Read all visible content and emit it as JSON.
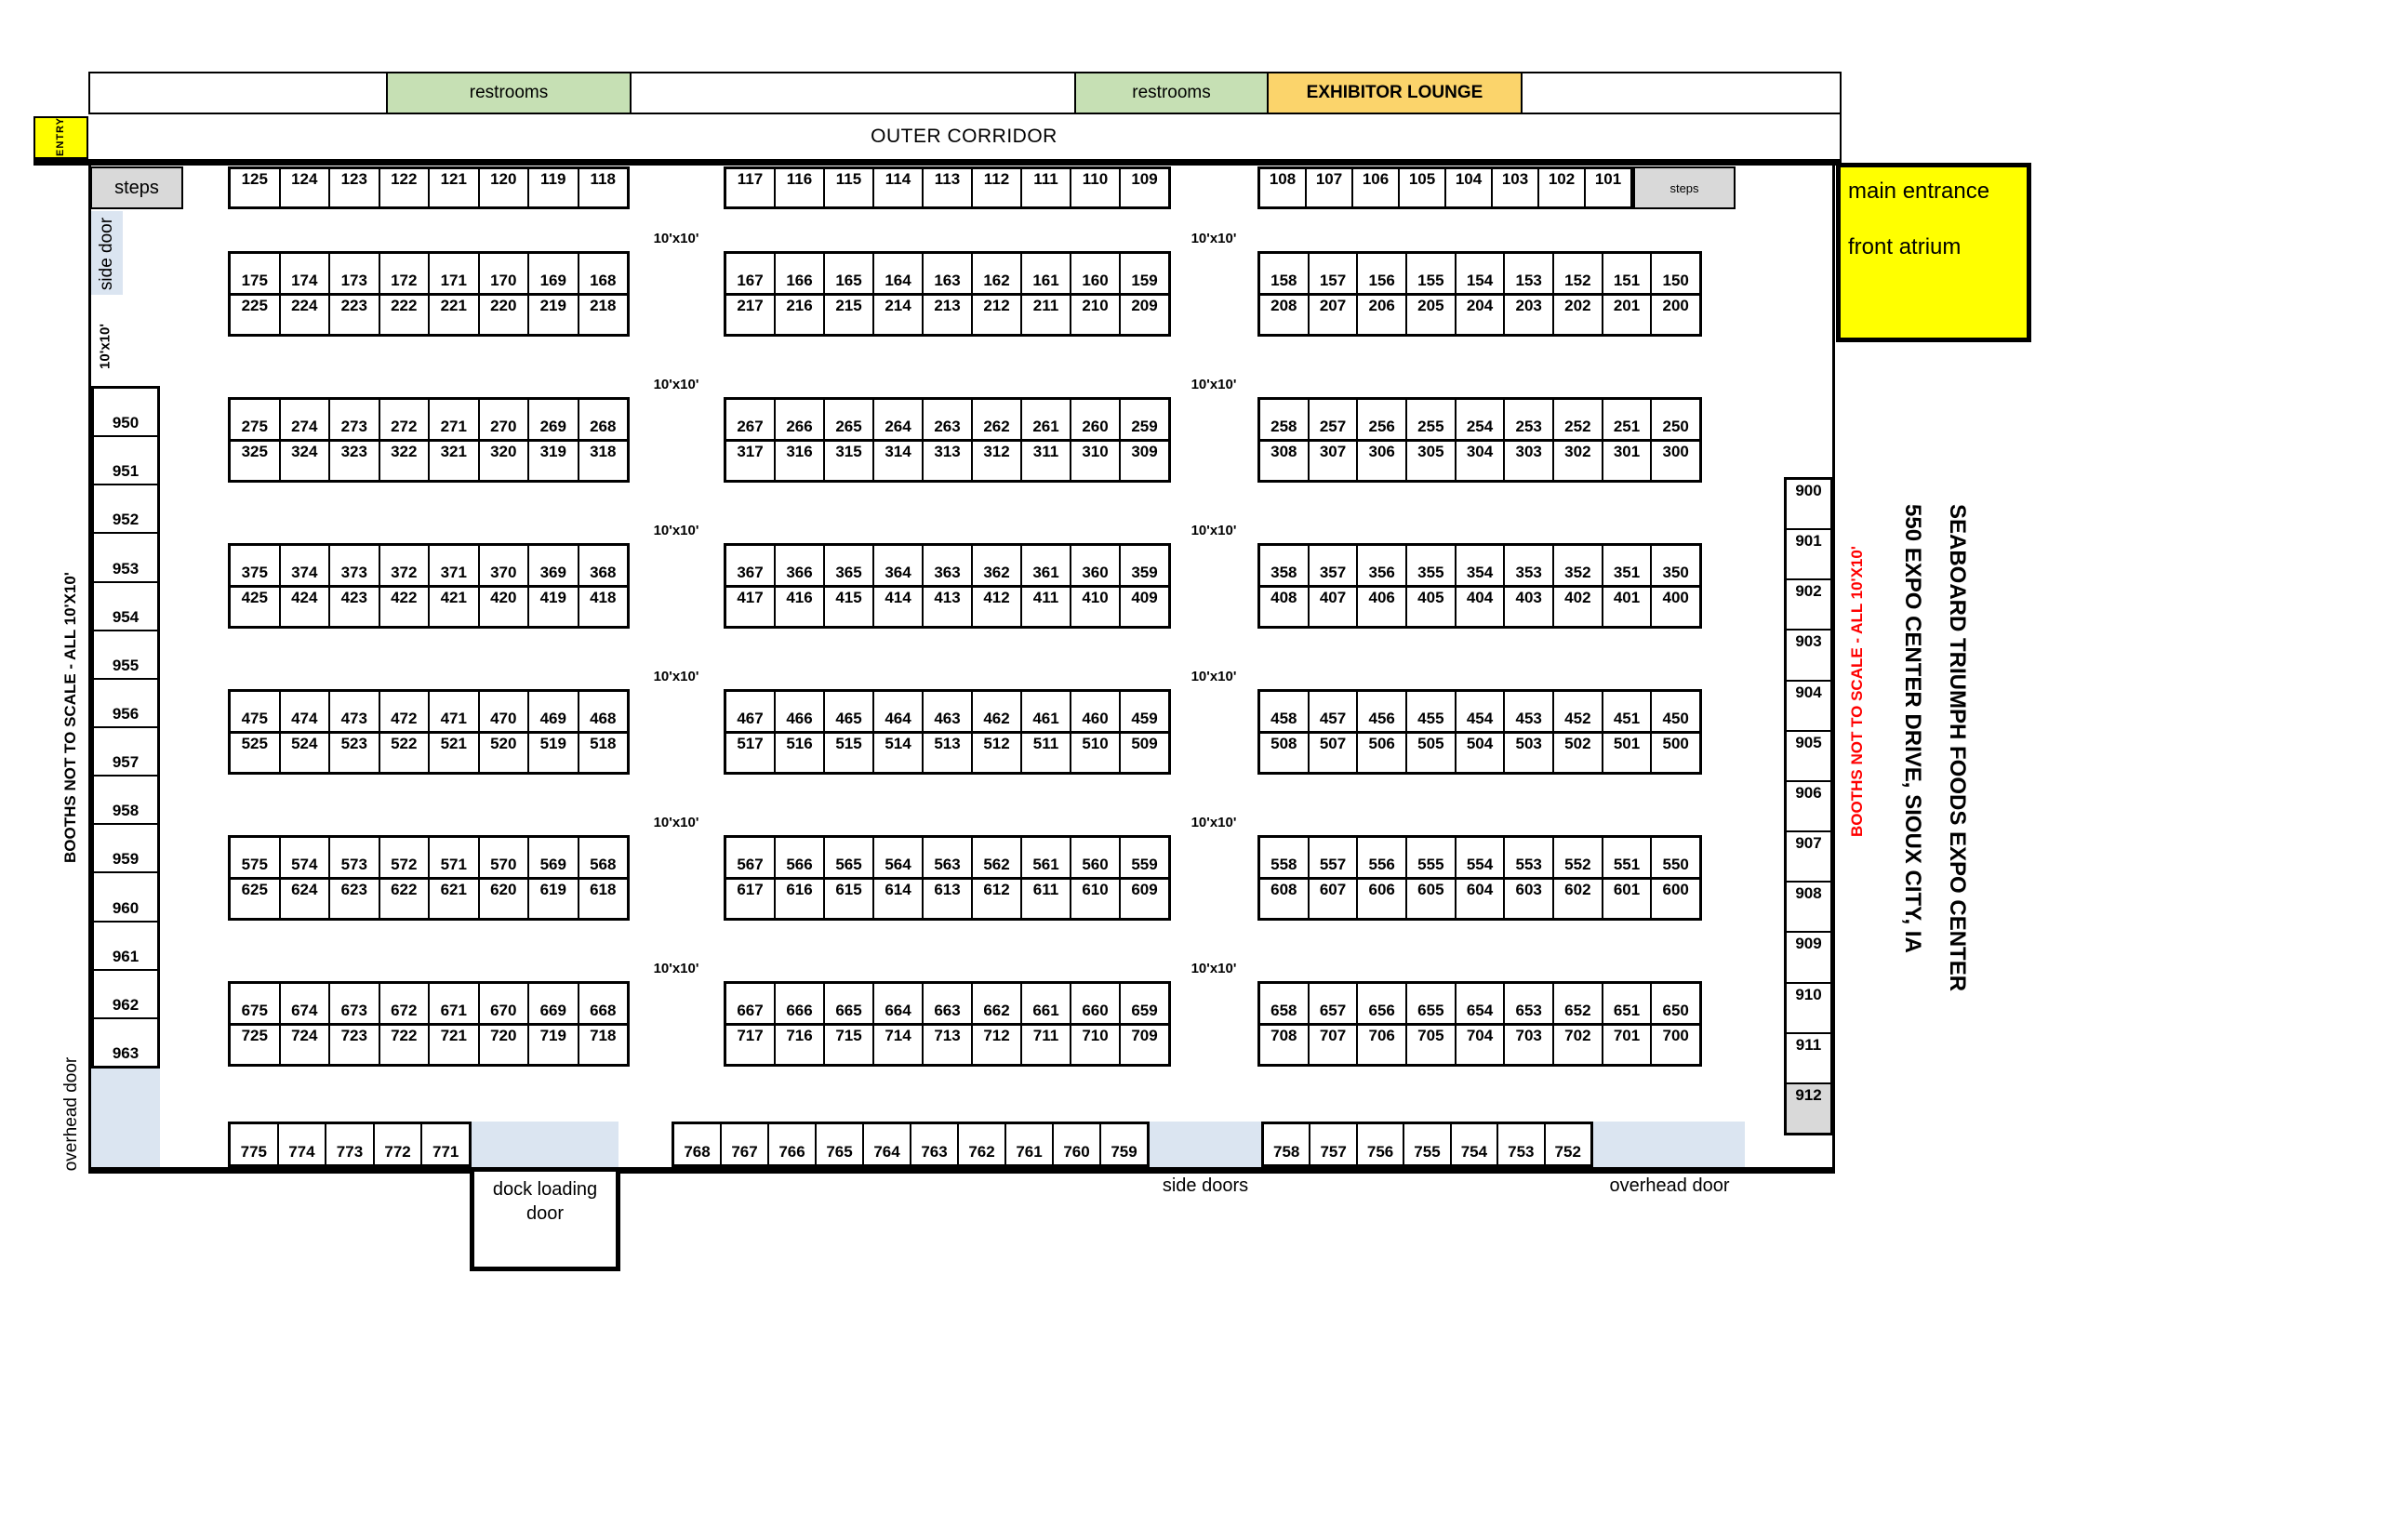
{
  "venue": {
    "name": "SEABOARD TRIUMPH FOODS EXPO CENTER",
    "address": "550 EXPO CENTER DRIVE,  SIOUX CITY, IA"
  },
  "corridor_label": "OUTER CORRIDOR",
  "entry_label": "ENTRY",
  "top_strip": {
    "restrooms_left": "restrooms",
    "restrooms_right": "restrooms",
    "exhibitor_lounge": "EXHIBITOR LOUNGE"
  },
  "entrance": {
    "line1": "main entrance",
    "line2": "front atrium"
  },
  "notes": {
    "left": "BOOTHS NOT TO SCALE - ALL 10'X10'",
    "right": "BOOTHS NOT TO SCALE - ALL 10'X10'"
  },
  "size_label": "10'x10'",
  "steps": {
    "left": "steps",
    "right": "steps"
  },
  "doors": {
    "side_door": "side door",
    "overhead_left": "overhead door",
    "dock": "dock loading door",
    "side_doors": "side doors",
    "overhead_bottom": "overhead door"
  },
  "booths": {
    "row1": {
      "left": [
        "125",
        "124",
        "123",
        "122",
        "121",
        "120",
        "119",
        "118"
      ],
      "middle": [
        "117",
        "116",
        "115",
        "114",
        "113",
        "112",
        "111",
        "110",
        "109"
      ],
      "right": [
        "108",
        "107",
        "106",
        "105",
        "104",
        "103",
        "102",
        "101"
      ]
    },
    "pairs": [
      {
        "top": {
          "left": [
            "175",
            "174",
            "173",
            "172",
            "171",
            "170",
            "169",
            "168"
          ],
          "middle": [
            "167",
            "166",
            "165",
            "164",
            "163",
            "162",
            "161",
            "160",
            "159"
          ],
          "right": [
            "158",
            "157",
            "156",
            "155",
            "154",
            "153",
            "152",
            "151",
            "150"
          ]
        },
        "bottom": {
          "left": [
            "225",
            "224",
            "223",
            "222",
            "221",
            "220",
            "219",
            "218"
          ],
          "middle": [
            "217",
            "216",
            "215",
            "214",
            "213",
            "212",
            "211",
            "210",
            "209"
          ],
          "right": [
            "208",
            "207",
            "206",
            "205",
            "204",
            "203",
            "202",
            "201",
            "200"
          ]
        }
      },
      {
        "top": {
          "left": [
            "275",
            "274",
            "273",
            "272",
            "271",
            "270",
            "269",
            "268"
          ],
          "middle": [
            "267",
            "266",
            "265",
            "264",
            "263",
            "262",
            "261",
            "260",
            "259"
          ],
          "right": [
            "258",
            "257",
            "256",
            "255",
            "254",
            "253",
            "252",
            "251",
            "250"
          ]
        },
        "bottom": {
          "left": [
            "325",
            "324",
            "323",
            "322",
            "321",
            "320",
            "319",
            "318"
          ],
          "middle": [
            "317",
            "316",
            "315",
            "314",
            "313",
            "312",
            "311",
            "310",
            "309"
          ],
          "right": [
            "308",
            "307",
            "306",
            "305",
            "304",
            "303",
            "302",
            "301",
            "300"
          ]
        }
      },
      {
        "top": {
          "left": [
            "375",
            "374",
            "373",
            "372",
            "371",
            "370",
            "369",
            "368"
          ],
          "middle": [
            "367",
            "366",
            "365",
            "364",
            "363",
            "362",
            "361",
            "360",
            "359"
          ],
          "right": [
            "358",
            "357",
            "356",
            "355",
            "354",
            "353",
            "352",
            "351",
            "350"
          ]
        },
        "bottom": {
          "left": [
            "425",
            "424",
            "423",
            "422",
            "421",
            "420",
            "419",
            "418"
          ],
          "middle": [
            "417",
            "416",
            "415",
            "414",
            "413",
            "412",
            "411",
            "410",
            "409"
          ],
          "right": [
            "408",
            "407",
            "406",
            "405",
            "404",
            "403",
            "402",
            "401",
            "400"
          ]
        }
      },
      {
        "top": {
          "left": [
            "475",
            "474",
            "473",
            "472",
            "471",
            "470",
            "469",
            "468"
          ],
          "middle": [
            "467",
            "466",
            "465",
            "464",
            "463",
            "462",
            "461",
            "460",
            "459"
          ],
          "right": [
            "458",
            "457",
            "456",
            "455",
            "454",
            "453",
            "452",
            "451",
            "450"
          ]
        },
        "bottom": {
          "left": [
            "525",
            "524",
            "523",
            "522",
            "521",
            "520",
            "519",
            "518"
          ],
          "middle": [
            "517",
            "516",
            "515",
            "514",
            "513",
            "512",
            "511",
            "510",
            "509"
          ],
          "right": [
            "508",
            "507",
            "506",
            "505",
            "504",
            "503",
            "502",
            "501",
            "500"
          ]
        }
      },
      {
        "top": {
          "left": [
            "575",
            "574",
            "573",
            "572",
            "571",
            "570",
            "569",
            "568"
          ],
          "middle": [
            "567",
            "566",
            "565",
            "564",
            "563",
            "562",
            "561",
            "560",
            "559"
          ],
          "right": [
            "558",
            "557",
            "556",
            "555",
            "554",
            "553",
            "552",
            "551",
            "550"
          ]
        },
        "bottom": {
          "left": [
            "625",
            "624",
            "623",
            "622",
            "621",
            "620",
            "619",
            "618"
          ],
          "middle": [
            "617",
            "616",
            "615",
            "614",
            "613",
            "612",
            "611",
            "610",
            "609"
          ],
          "right": [
            "608",
            "607",
            "606",
            "605",
            "604",
            "603",
            "602",
            "601",
            "600"
          ]
        }
      },
      {
        "top": {
          "left": [
            "675",
            "674",
            "673",
            "672",
            "671",
            "670",
            "669",
            "668"
          ],
          "middle": [
            "667",
            "666",
            "665",
            "664",
            "663",
            "662",
            "661",
            "660",
            "659"
          ],
          "right": [
            "658",
            "657",
            "656",
            "655",
            "654",
            "653",
            "652",
            "651",
            "650"
          ]
        },
        "bottom": {
          "left": [
            "725",
            "724",
            "723",
            "722",
            "721",
            "720",
            "719",
            "718"
          ],
          "middle": [
            "717",
            "716",
            "715",
            "714",
            "713",
            "712",
            "711",
            "710",
            "709"
          ],
          "right": [
            "708",
            "707",
            "706",
            "705",
            "704",
            "703",
            "702",
            "701",
            "700"
          ]
        }
      }
    ],
    "bottom_row": {
      "left": [
        "775",
        "774",
        "773",
        "772",
        "771"
      ],
      "middle": [
        "768",
        "767",
        "766",
        "765",
        "764",
        "763",
        "762",
        "761",
        "760",
        "759"
      ],
      "right": [
        "758",
        "757",
        "756",
        "755",
        "754",
        "753",
        "752"
      ]
    },
    "left_column": [
      "950",
      "951",
      "952",
      "953",
      "954",
      "955",
      "956",
      "957",
      "958",
      "959",
      "960",
      "961",
      "962",
      "963"
    ],
    "right_column": [
      "900",
      "901",
      "902",
      "903",
      "904",
      "905",
      "906",
      "907",
      "908",
      "909",
      "910",
      "911",
      "912"
    ],
    "shaded_booth": "912"
  },
  "colors": {
    "restrooms": "#c6e0b4",
    "lounge": "#fbd46b",
    "highlight_yellow": "#ffff00",
    "door_blue": "#dbe5f1",
    "steps_gray": "#d9d9d9",
    "note_red": "#ff0000"
  }
}
